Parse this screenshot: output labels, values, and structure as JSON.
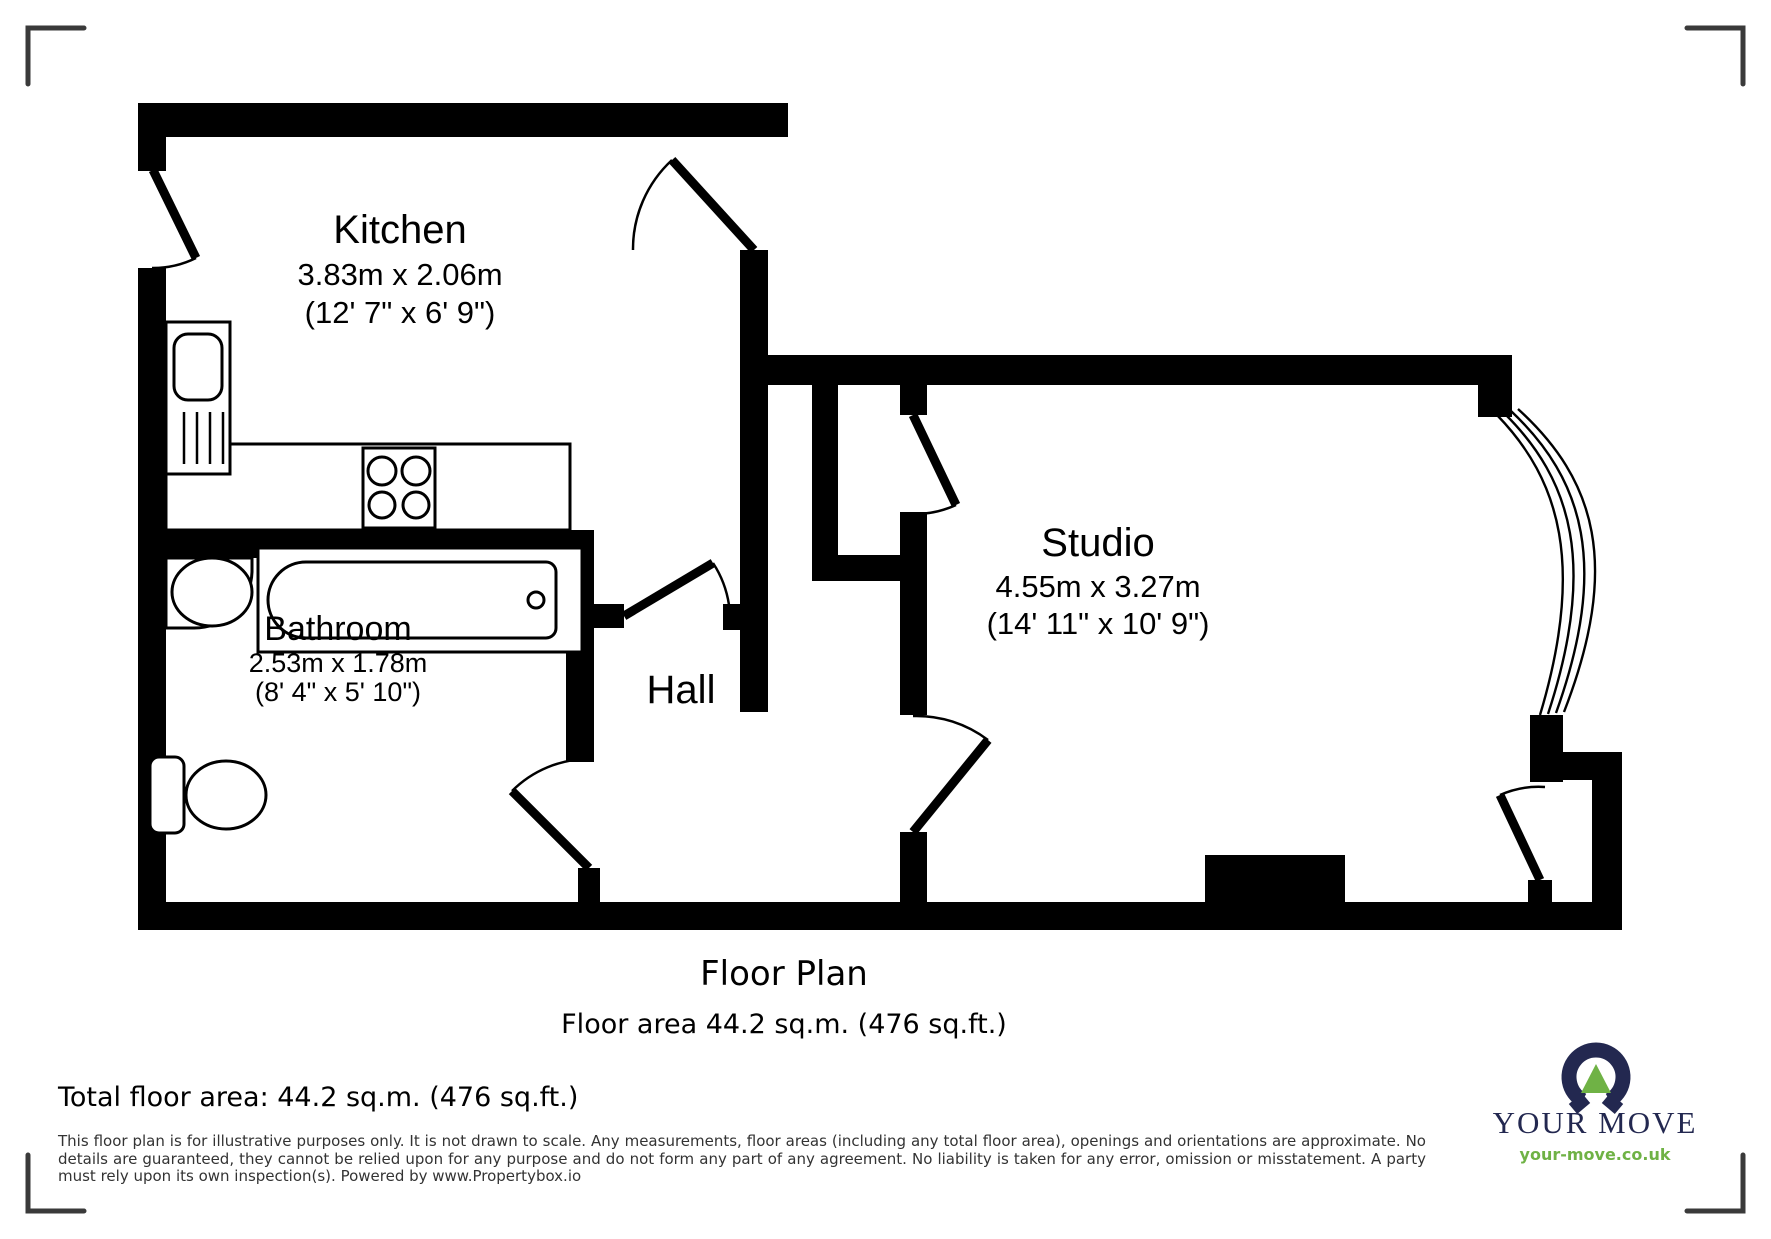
{
  "rooms": {
    "kitchen": {
      "name": "Kitchen",
      "metric": "3.83m x 2.06m",
      "imperial": "(12' 7\" x 6' 9\")"
    },
    "bathroom": {
      "name": "Bathroom",
      "metric": "2.53m x 1.78m",
      "imperial": "(8' 4\" x 5' 10\")"
    },
    "hall": {
      "name": "Hall"
    },
    "studio": {
      "name": "Studio",
      "metric": "4.55m x 3.27m",
      "imperial": "(14' 11\" x 10' 9\")"
    }
  },
  "plan": {
    "title": "Floor Plan",
    "subtitle": "Floor area 44.2 sq.m. (476 sq.ft.)"
  },
  "footer": {
    "total_area": "Total floor area: 44.2 sq.m. (476 sq.ft.)",
    "disclaimer": "This floor plan is for illustrative purposes only. It is not drawn to scale. Any measurements, floor areas (including any total floor area), openings and orientations are approximate. No details are guaranteed, they cannot be relied upon for any purpose and do not form any part of any agreement. No liability is taken for any error, omission or misstatement. A party must rely upon its own inspection(s). Powered by www.Propertybox.io"
  },
  "logo": {
    "brand": "YOUR MOVE",
    "website": "your-move.co.uk",
    "colors": {
      "navy": "#232850",
      "green": "#6fb245"
    }
  }
}
